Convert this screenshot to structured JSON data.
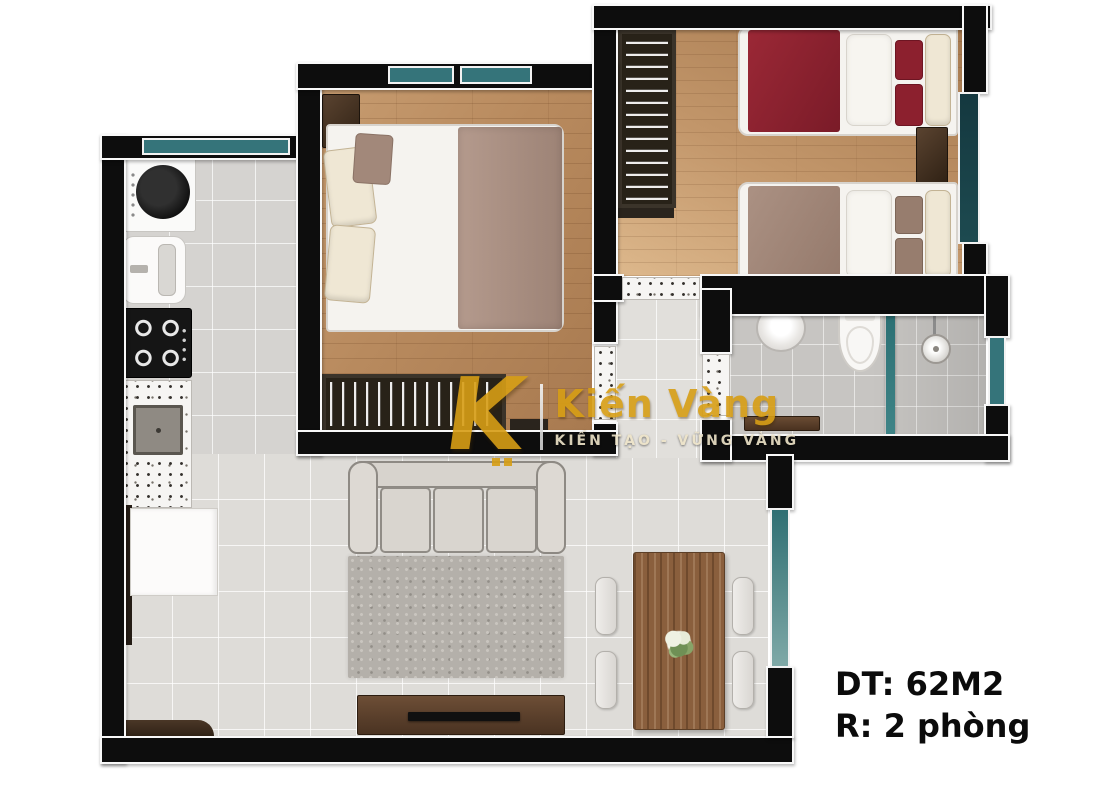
{
  "annotation": {
    "area_label": "DT: 62M2",
    "rooms_label": "R: 2 phòng"
  },
  "watermark": {
    "logo_letter": "K",
    "brand_name": "Kiến Vàng",
    "tagline": "KIẾN TẠO - VỮNG VÀNG",
    "gold_color": "#D79E15"
  },
  "floor_plan": {
    "type": "apartment-top-view-3d-floor-plan",
    "total_area_m2": 62,
    "bedroom_count": 2,
    "rooms": [
      {
        "name": "kitchen",
        "floor": "gray-tile",
        "furniture": [
          "washing-machine",
          "sink-unit",
          "gas-stove-4-burners",
          "terrazzo-counter-with-square-sink",
          "white-cabinet",
          "entry-door",
          "entry-bench"
        ]
      },
      {
        "name": "master-bedroom",
        "floor": "wood-plank",
        "furniture": [
          "double-bed",
          "nightstand",
          "pillows",
          "mauve-blanket",
          "clothes-rack-with-hangers",
          "wall-shelf"
        ],
        "windows": 2
      },
      {
        "name": "second-bedroom",
        "floor": "wood-plank",
        "furniture": [
          "single-bed-red-bedding",
          "single-bed-taupe-bedding",
          "nightstand",
          "clothes-rack-with-hangers"
        ],
        "windows": 1
      },
      {
        "name": "bathroom",
        "floor": "gray-tile",
        "furniture": [
          "round-washbasin",
          "toilet",
          "glass-shower-partition",
          "shower-head",
          "wood-bench"
        ],
        "windows": 1
      },
      {
        "name": "living-room",
        "floor": "light-tile",
        "furniture": [
          "three-seat-sofa",
          "area-rug",
          "tv-console-with-tv"
        ],
        "windows": [
          "balcony-glass-door"
        ]
      },
      {
        "name": "dining-area",
        "floor": "light-tile",
        "furniture": [
          "wood-dining-table",
          "chair",
          "chair",
          "chair",
          "chair",
          "flower-centerpiece"
        ]
      },
      {
        "name": "hallway",
        "floor": "light-tile",
        "furniture": []
      }
    ],
    "colors": {
      "wall": "#0D0D0D",
      "wall_outline": "#F8F8F8",
      "wood_floor": "#B98A5F",
      "tile_floor": "#DEDCD8",
      "bath_tile": "#C7C5C2",
      "window_glass_teal": "#35747A",
      "red_bedding": "#8C202E",
      "taupe_bedding": "#A18878",
      "sofa_gray": "#D7D3CD",
      "furniture_wood": "#6D4E36"
    }
  }
}
